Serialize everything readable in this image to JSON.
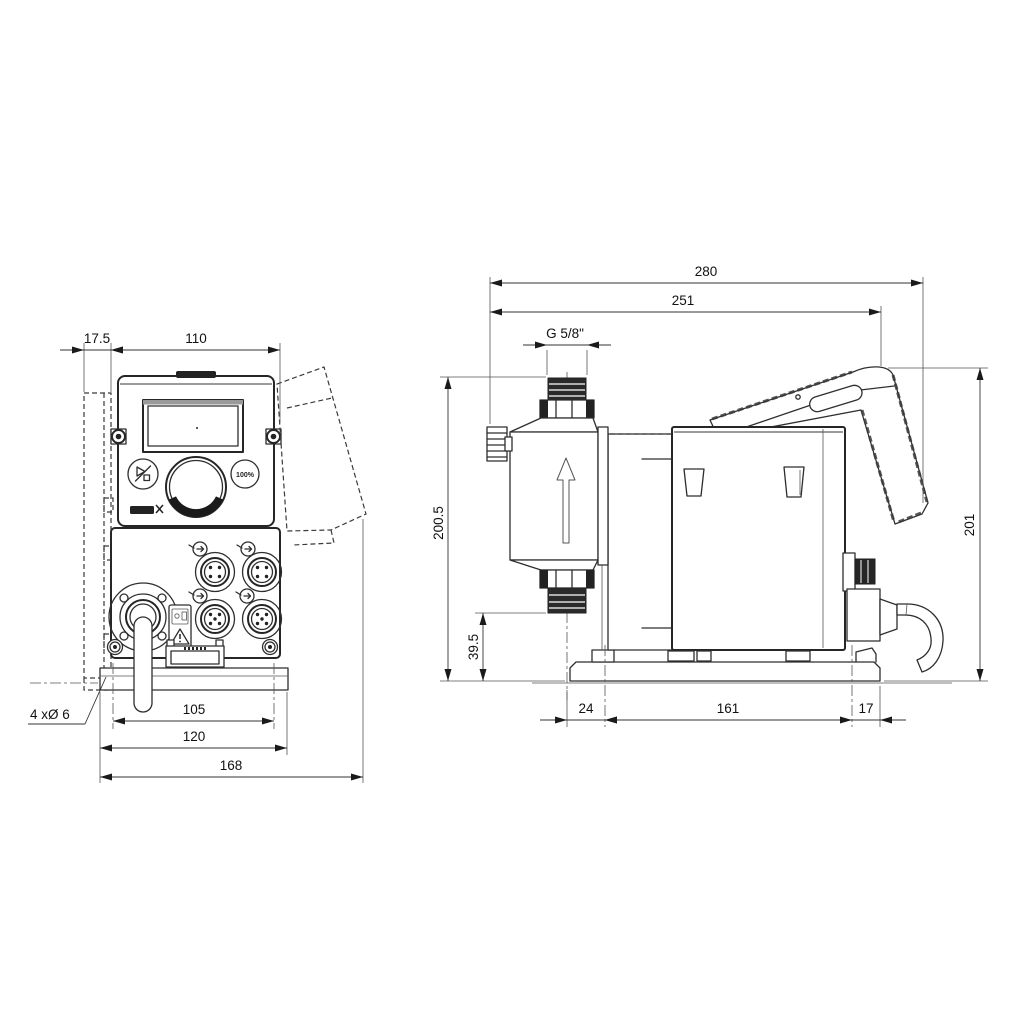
{
  "front_view": {
    "dims": {
      "bracket_offset": "17.5",
      "body_width": "110",
      "mounting_hole_spacing": "105",
      "plate_width": "120",
      "overall_width": "168",
      "mounting_holes": "4 xØ 6"
    },
    "panel": {
      "priming_button": "100%"
    }
  },
  "side_view": {
    "dims": {
      "overall_depth": "280",
      "depth_to_bracket": "251",
      "connection_thread": "G 5/8\"",
      "height_to_connection": "200.5",
      "height_to_valve": "39.5",
      "plate_front_offset": "24",
      "plate_hole_spacing": "161",
      "plate_rear_offset": "17",
      "overall_height": "201"
    }
  }
}
